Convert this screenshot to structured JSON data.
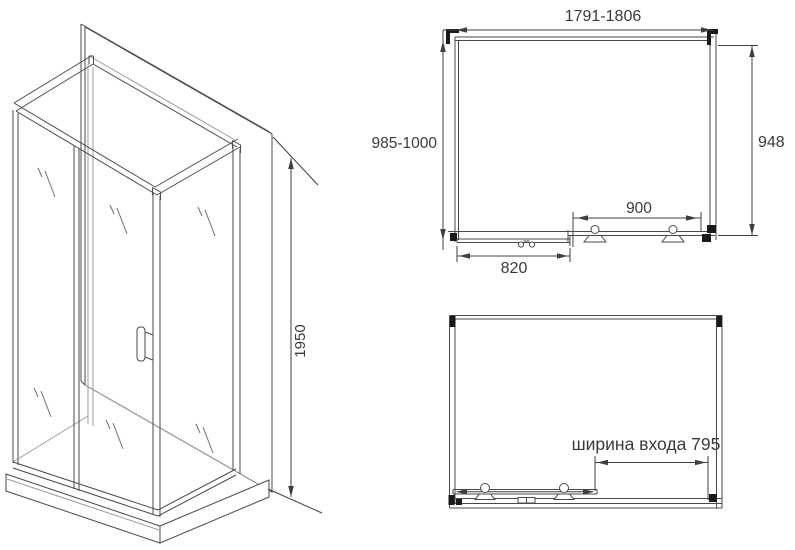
{
  "document": {
    "type": "shower-enclosure-technical-drawing",
    "background": "#ffffff"
  },
  "colors": {
    "line_dark": "#4a4a4a",
    "line_light": "#9b9b9b",
    "dimension_line": "#3f3f3f",
    "bracket_fill": "#1a1a1a",
    "text": "#3a3a3a"
  },
  "isometric_view": {
    "height_label": "1950"
  },
  "plan_view": {
    "top_width_label": "1791-1806",
    "left_depth_label": "985-1000",
    "right_depth_label": "948",
    "door_rail_label": "900",
    "fixed_panel_label": "820"
  },
  "front_view": {
    "entrance_width_label": "ширина входа 795"
  }
}
